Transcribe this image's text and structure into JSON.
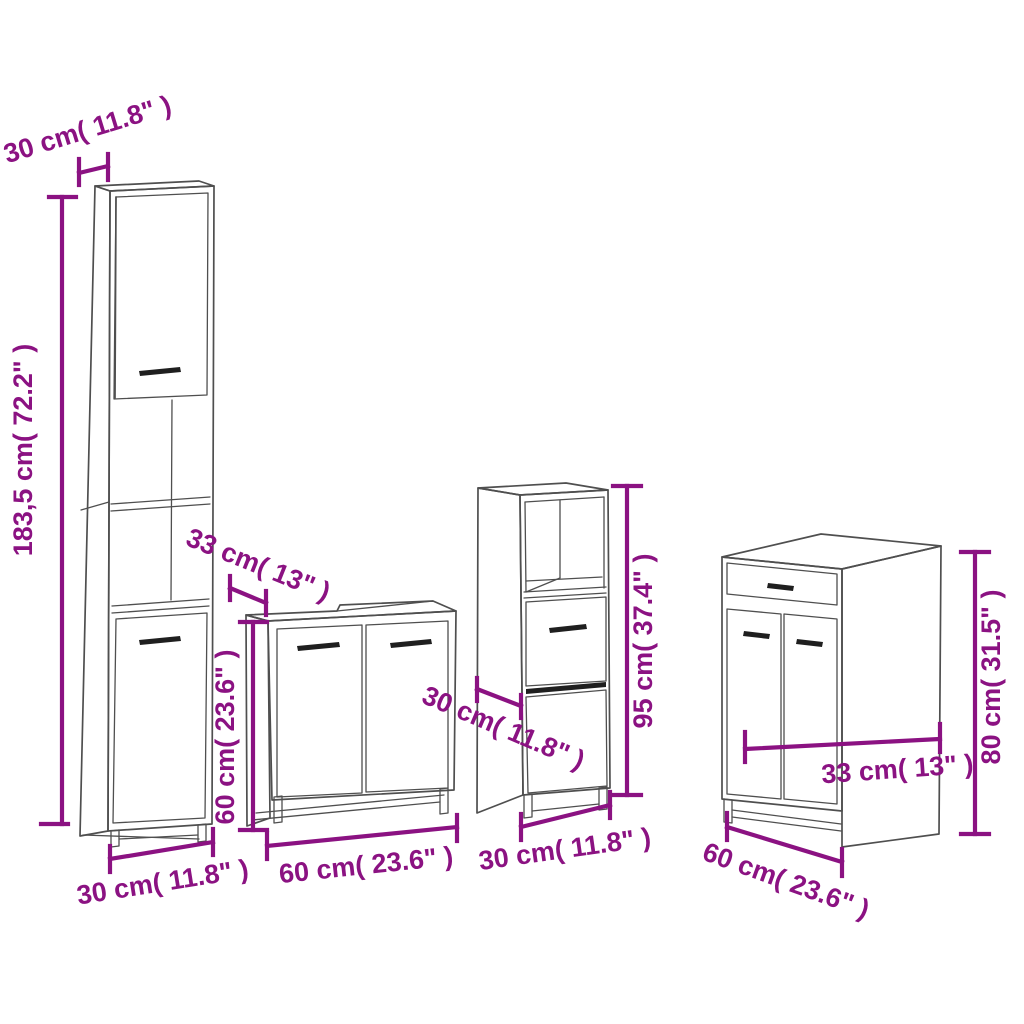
{
  "diagram": {
    "colors": {
      "background": "#ffffff",
      "dimension": "#8b1282",
      "outline": "#4f4f4f",
      "dark": "#1f1f1f"
    },
    "cabinets": {
      "tall": {
        "top_depth": "30 cm( 11.8\" )",
        "height": "183,5 cm( 72.2\" )",
        "width": "30 cm( 11.8\" )"
      },
      "sink": {
        "depth": "33 cm( 13\" )",
        "height": "60 cm( 23.6\" )",
        "width": "60 cm( 23.6\" )"
      },
      "slim": {
        "depth": "30 cm( 11.8\" )",
        "height": "95 cm( 37.4\" )",
        "width": "30 cm( 11.8\" )"
      },
      "side": {
        "depth": "33 cm( 13\" )",
        "height": "80 cm( 31.5\" )",
        "width": "60 cm( 23.6\" )"
      }
    }
  }
}
